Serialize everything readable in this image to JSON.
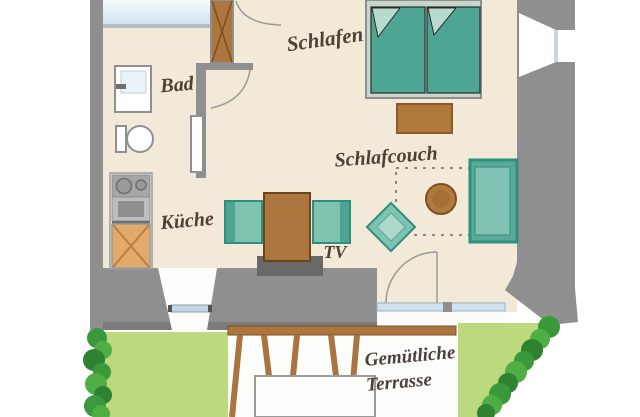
{
  "plan_type": "apartment-floor-plan",
  "labels": {
    "bedroom": "Schlafen",
    "bathroom": "Bad",
    "kitchen": "Küche",
    "sleepcouch": "Schlafcouch",
    "tv": "TV",
    "terrace_line1": "Gemütliche",
    "terrace_line2": "Terrasse"
  },
  "palette": {
    "floor": "#f2e9d8",
    "wall": "#8f8f8f",
    "wall_dark": "#7b7b7b",
    "tv_board": "#686868",
    "wood": "#ad763e",
    "wood_dark": "#7a4f22",
    "cabinet_wood": "#e2ab6c",
    "teal_dark": "#2f8f7e",
    "teal": "#4da694",
    "teal_light": "#7fc2b1",
    "teal_pale": "#aed8cb",
    "bed_frame": "#c6d6cb",
    "window_blue": "#cfe3ee",
    "lawn_green": "#bcd97e",
    "hedge_green": "#3a9a3b",
    "label_ink": "#4b4138",
    "white_floor": "#fdfdfb"
  },
  "furniture": [
    "double-bed",
    "bed-bench",
    "sleeper-sofa",
    "sofa-foldout-outline",
    "round-side-table",
    "diamond-stool",
    "dining-table",
    "dining-chair-left",
    "dining-chair-right",
    "tv-lowboard",
    "kitchen-cooktop",
    "kitchen-oven",
    "kitchen-cabinet",
    "bathroom-sink",
    "toilet",
    "bathroom-window",
    "entry-door",
    "bathroom-door-swing",
    "terrace-door-swing",
    "terrace-glass-door",
    "pergola-beam",
    "pergola-posts",
    "terrace-table",
    "lawn-left",
    "lawn-right",
    "hedge-left",
    "hedge-right",
    "side-window"
  ]
}
